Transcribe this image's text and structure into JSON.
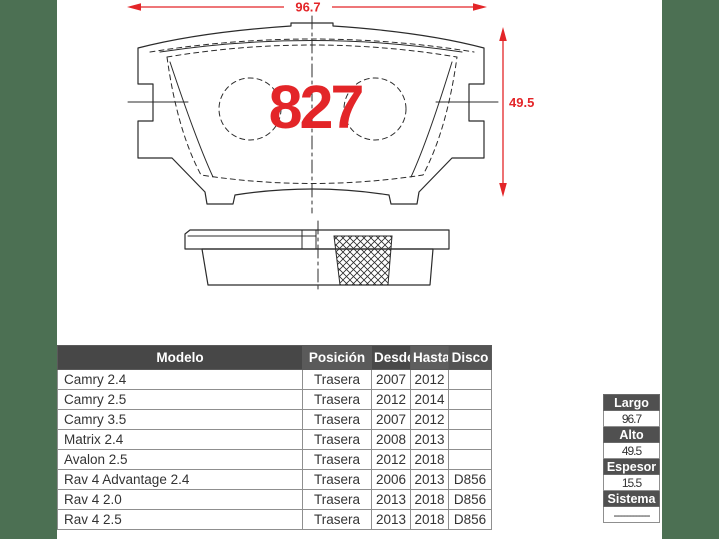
{
  "page": {
    "side_band_color": "#4c7053",
    "card_background": "#ffffff"
  },
  "drawing": {
    "part_number": "827",
    "width_dimension": "96.7",
    "height_dimension": "49.5",
    "accent_color": "#e32528",
    "line_color": "#2b2b2b"
  },
  "applications_table": {
    "headers": [
      "Modelo",
      "Posición",
      "Desde",
      "Hasta",
      "Disco"
    ],
    "header_colors": [
      "#474747",
      "#5a5a5a",
      "#494949",
      "#5e5e5e",
      "#545454"
    ],
    "rows": [
      {
        "modelo": "Camry 2.4",
        "posicion": "Trasera",
        "desde": "2007",
        "hasta": "2012",
        "disco": ""
      },
      {
        "modelo": "Camry 2.5",
        "posicion": "Trasera",
        "desde": "2012",
        "hasta": "2014",
        "disco": ""
      },
      {
        "modelo": "Camry 3.5",
        "posicion": "Trasera",
        "desde": "2007",
        "hasta": "2012",
        "disco": ""
      },
      {
        "modelo": "Matrix 2.4",
        "posicion": "Trasera",
        "desde": "2008",
        "hasta": "2013",
        "disco": ""
      },
      {
        "modelo": "Avalon 2.5",
        "posicion": "Trasera",
        "desde": "2012",
        "hasta": "2018",
        "disco": ""
      },
      {
        "modelo": "Rav 4 Advantage 2.4",
        "posicion": "Trasera",
        "desde": "2006",
        "hasta": "2013",
        "disco": "D856"
      },
      {
        "modelo": "Rav 4 2.0",
        "posicion": "Trasera",
        "desde": "2013",
        "hasta": "2018",
        "disco": "D856"
      },
      {
        "modelo": "Rav 4 2.5",
        "posicion": "Trasera",
        "desde": "2013",
        "hasta": "2018",
        "disco": "D856"
      }
    ]
  },
  "specs_table": {
    "items": [
      {
        "label": "Largo",
        "value": "96.7"
      },
      {
        "label": "Alto",
        "value": "49.5"
      },
      {
        "label": "Espesor",
        "value": "15.5"
      },
      {
        "label": "Sistema",
        "value": "------------"
      }
    ]
  }
}
